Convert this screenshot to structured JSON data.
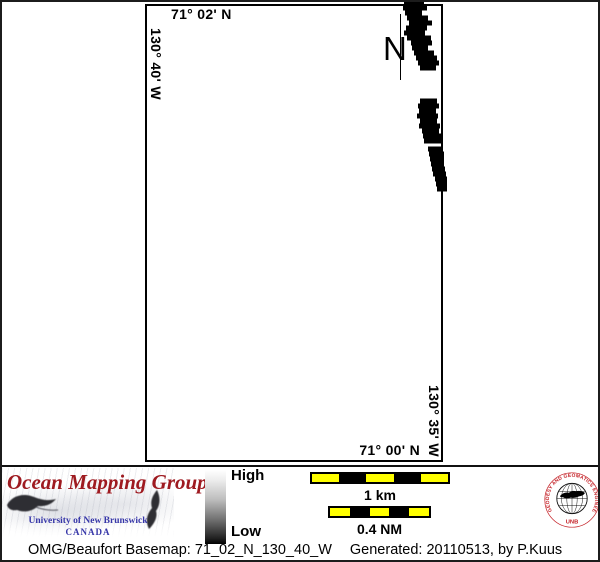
{
  "map": {
    "labels": {
      "top_lat": "71° 02' N",
      "left_lon": "130° 40' W",
      "right_lon": "130° 35' W",
      "bottom_lat": "71° 00' N"
    },
    "north_label": "N"
  },
  "legend": {
    "high_label": "High",
    "low_label": "Low",
    "high_color": "#ffffff",
    "low_color": "#000000"
  },
  "scalebars": {
    "km": {
      "label": "1 km",
      "segments": [
        "#ffff00",
        "#000000",
        "#ffff00",
        "#000000",
        "#ffff00"
      ]
    },
    "nm": {
      "label": "0.4 NM",
      "segments": [
        "#ffff00",
        "#000000",
        "#ffff00",
        "#000000",
        "#ffff00"
      ]
    }
  },
  "logo": {
    "title": "Ocean Mapping Group",
    "subtitle": "University of New Brunswick",
    "country": "CANADA",
    "title_color": "#9e1a20",
    "subtitle_color": "#3636a8"
  },
  "seal": {
    "ring_text": "GEODESY AND GEOMATICS ENGINEERING",
    "bottom_text": "UNB",
    "color": "#c41f25"
  },
  "footer": {
    "basemap_label": "OMG/Beaufort Basemap: 71_02_N_130_40_W",
    "generated_label": "Generated: 20110513, by P.Kuus"
  }
}
